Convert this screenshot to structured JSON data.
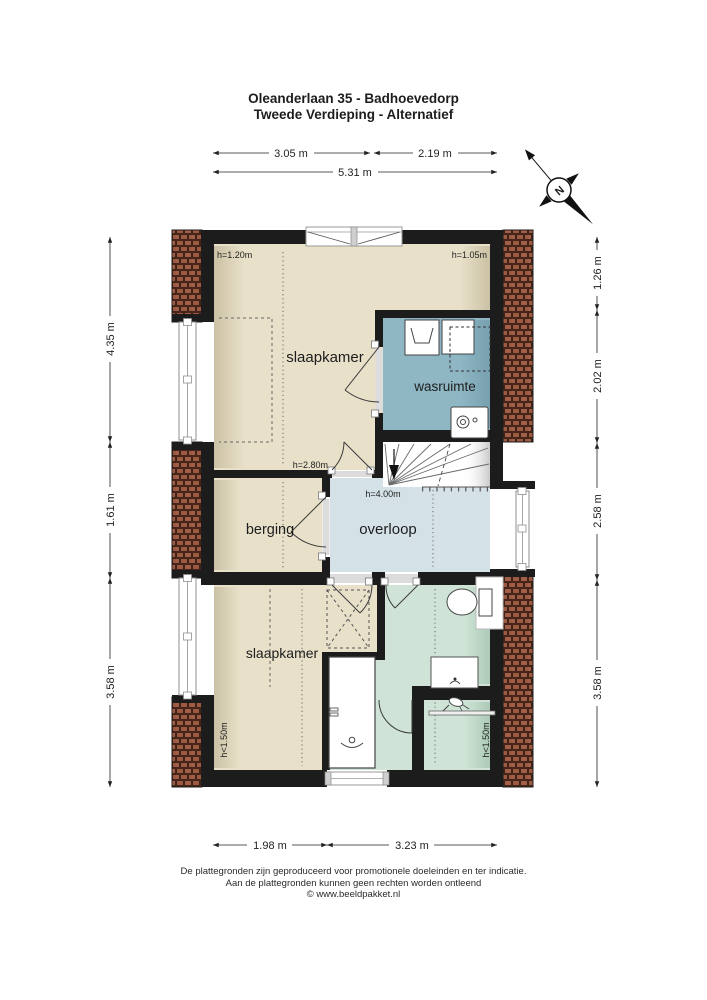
{
  "title": {
    "line1": "Oleanderlaan 35 - Badhoevedorp",
    "line2": "Tweede Verdieping - Alternatief"
  },
  "compass": {
    "north_label": "N"
  },
  "rooms": {
    "slaapkamer_top": "slaapkamer",
    "wasruimte": "wasruimte",
    "berging": "berging",
    "overloop": "overloop",
    "slaapkamer_bottom": "slaapkamer"
  },
  "height_labels": {
    "top_left": "h=1.20m",
    "top_right": "h=1.05m",
    "slaapkamer_door": "h=2.80m",
    "overloop": "h=4.00m",
    "bottom_left": "h<1.50m",
    "bottom_right": "h<1.50m"
  },
  "dimensions": {
    "top": [
      "3.05 m",
      "2.19 m",
      "5.31 m"
    ],
    "left": [
      "4.35 m",
      "1.61 m",
      "3.58 m"
    ],
    "right": [
      "1.26 m",
      "2.02 m",
      "2.58 m",
      "3.58 m"
    ],
    "bottom": [
      "1.98 m",
      "3.23 m"
    ]
  },
  "footer": [
    "De plattegronden zijn geproduceerd voor promotionele doeleinden en ter indicatie.",
    "Aan de plattegronden kunnen geen rechten worden ontleend",
    "© www.beeldpakket.nl"
  ],
  "colors": {
    "wall": "#1c1c1c",
    "room_beige": "#e8e0c9",
    "room_blue": "#8fb6c3",
    "overloop_blue": "#d4e2e8",
    "bathroom_green": "#cfe4d6",
    "tile_red": "#9c5a42",
    "text": "#1f1f1f"
  }
}
